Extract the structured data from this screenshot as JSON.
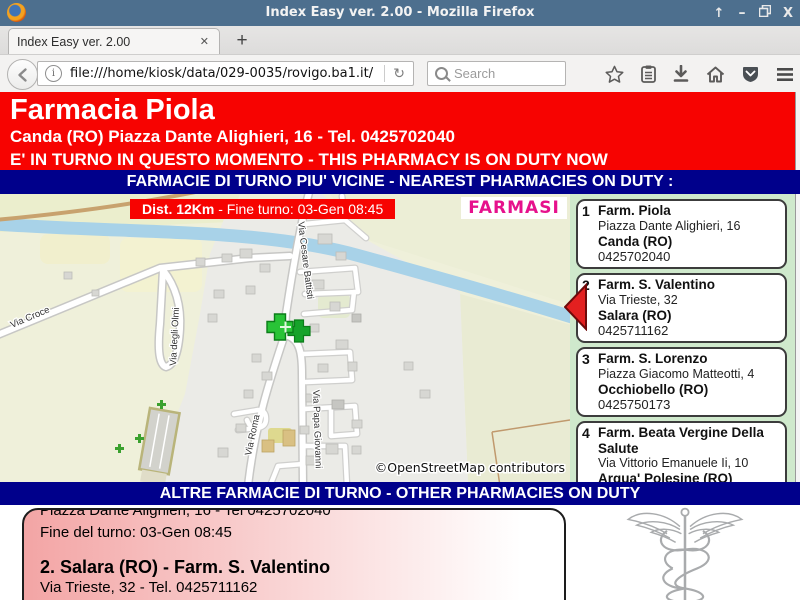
{
  "window": {
    "title": "Index Easy ver. 2.00 - Mozilla Firefox",
    "icons": {
      "shade": "↑",
      "minimize": "–",
      "close": "X"
    }
  },
  "browser": {
    "tab_title": "Index Easy ver. 2.00",
    "tab_close": "✕",
    "new_tab": "+",
    "back": "←",
    "info": "i",
    "reload": "↻",
    "url": "file:///home/kiosk/data/029-0035/rovigo.ba1.it/",
    "search_placeholder": "Search",
    "home": "⌂"
  },
  "header": {
    "pharmacy_name": "Farmacia Piola",
    "address_line": "Canda (RO) Piazza Dante Alighieri, 16 - Tel. 0425702040",
    "duty_line": "E' IN TURNO IN QUESTO MOMENTO - THIS PHARMACY IS ON DUTY NOW"
  },
  "bars": {
    "nearest": "FARMACIE DI TURNO PIU' VICINE - NEAREST PHARMACIES ON DUTY :",
    "other": "ALTRE FARMACIE DI TURNO - OTHER PHARMACIES ON DUTY"
  },
  "map": {
    "distance_bold": "Dist. 12Km",
    "distance_rest": " - Fine turno: 03-Gen 08:45",
    "logo": "FARMASI",
    "street_labels": [
      "Via Croce",
      "Via degli Olmi",
      "Via Cesare Battisti",
      "Via Roma",
      "Via Papa Giovanni"
    ],
    "attribution": "©OpenStreetMap contributors"
  },
  "pharmacy_list": [
    {
      "num": "1",
      "name": "Farm. Piola",
      "address": "Piazza Dante Alighieri, 16",
      "city": "Canda (RO)",
      "phone": "0425702040"
    },
    {
      "num": "2",
      "name": "Farm. S. Valentino",
      "address": "Via Trieste, 32",
      "city": "Salara (RO)",
      "phone": "0425711162"
    },
    {
      "num": "3",
      "name": "Farm. S. Lorenzo",
      "address": "Piazza Giacomo Matteotti, 4",
      "city": "Occhiobello (RO)",
      "phone": "0425750173"
    },
    {
      "num": "4",
      "name": "Farm. Beata Vergine Della Salute",
      "address": "Via Vittorio Emanuele Ii, 10",
      "city": "Arqua' Polesine (RO)",
      "phone": "042591029"
    }
  ],
  "ticker": {
    "clipped_top": "Piazza Dante Alighieri, 16 - Tel 0425702040",
    "line1": "Fine del turno: 03-Gen 08:45",
    "entry_title": "2. Salara (RO) - Farm. S. Valentino",
    "entry_address": "Via Trieste, 32 - Tel. 0425711162",
    "clipped_bottom": "Fine del turno: 03-Gen 08:45"
  },
  "colors": {
    "titlebar": "#4d6f8e",
    "header_red": "#f70301",
    "navy_bar": "#00008b",
    "sidebar_green": "#cfe9cc",
    "logo_magenta": "#e6118c",
    "ticker_pink": "#f3a5a5",
    "marker_green": "#29c337",
    "river_blue": "#a8d2e8"
  }
}
